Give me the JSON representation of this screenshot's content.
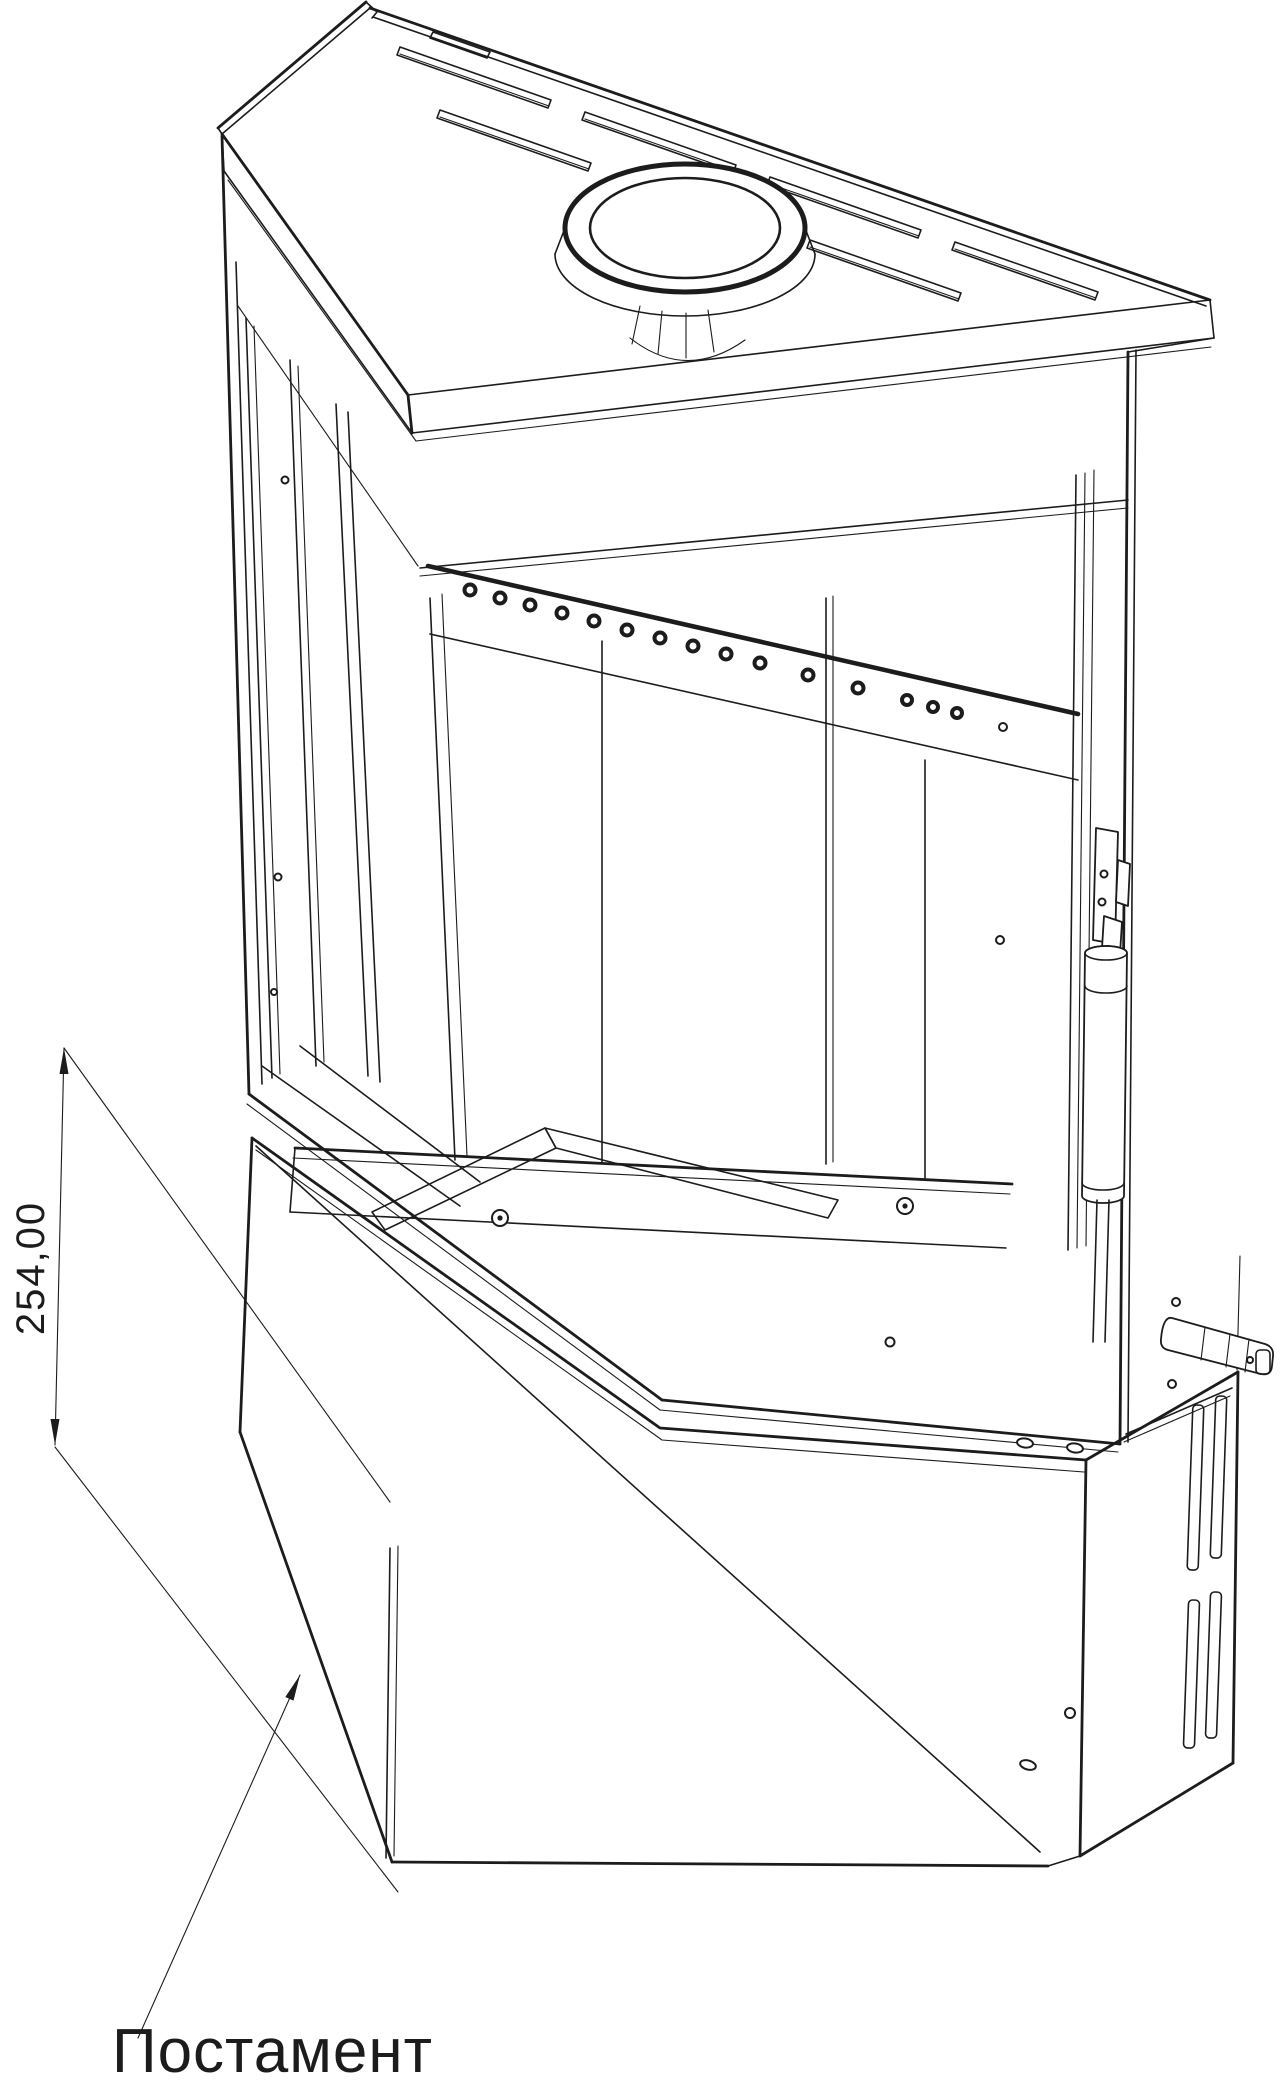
{
  "drawing": {
    "title": "corner-stove-technical-drawing",
    "dimension": {
      "value": "254,00",
      "orientation": "vertical",
      "measures": "pedestal-height"
    },
    "callout": {
      "label": "Постамент",
      "points_to": "pedestal"
    }
  },
  "colors": {
    "line": "#1c1c1c",
    "background": "#ffffff"
  }
}
